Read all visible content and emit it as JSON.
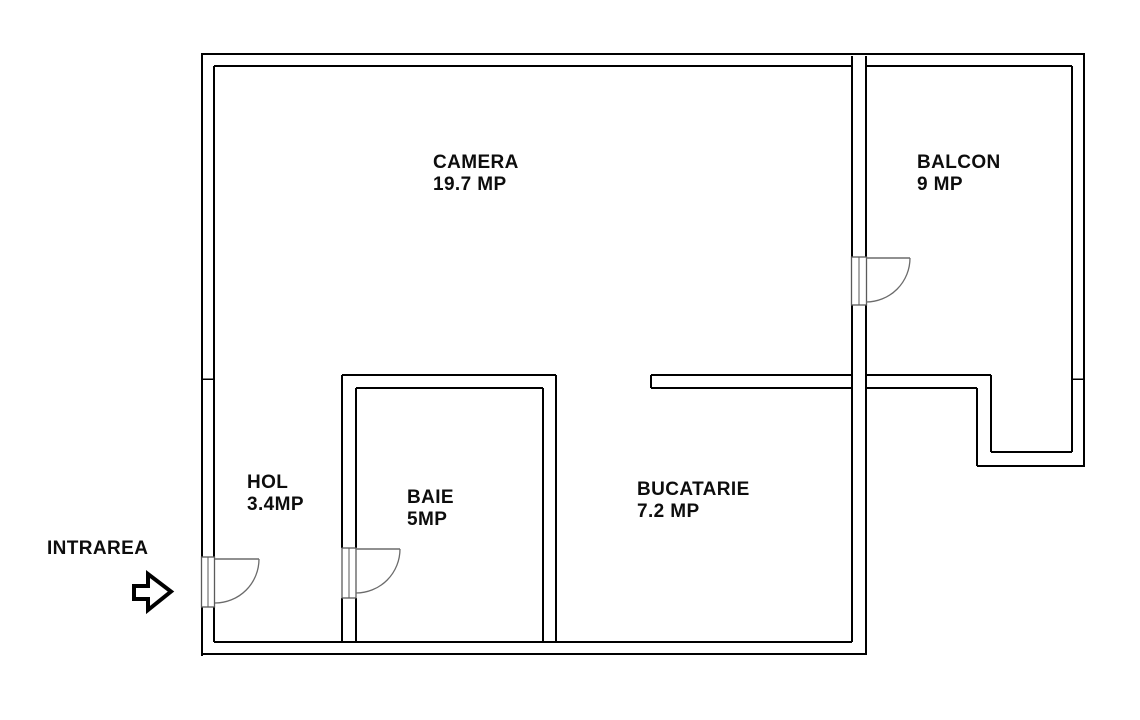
{
  "plan_title": "apartment floor plan",
  "colors": {
    "background": "#ffffff",
    "wall": "#000000",
    "door": "#6b6b6b"
  },
  "rooms": [
    {
      "name": "CAMERA",
      "area": "19.7 MP"
    },
    {
      "name": "BALCON",
      "area": "9 MP"
    },
    {
      "name": "HOL",
      "area": "3.4MP"
    },
    {
      "name": "BAIE",
      "area": "5MP"
    },
    {
      "name": "BUCATARIE",
      "area": "7.2 MP"
    }
  ],
  "entrance": {
    "label": "INTRAREA",
    "icon": "right-arrow-icon"
  }
}
